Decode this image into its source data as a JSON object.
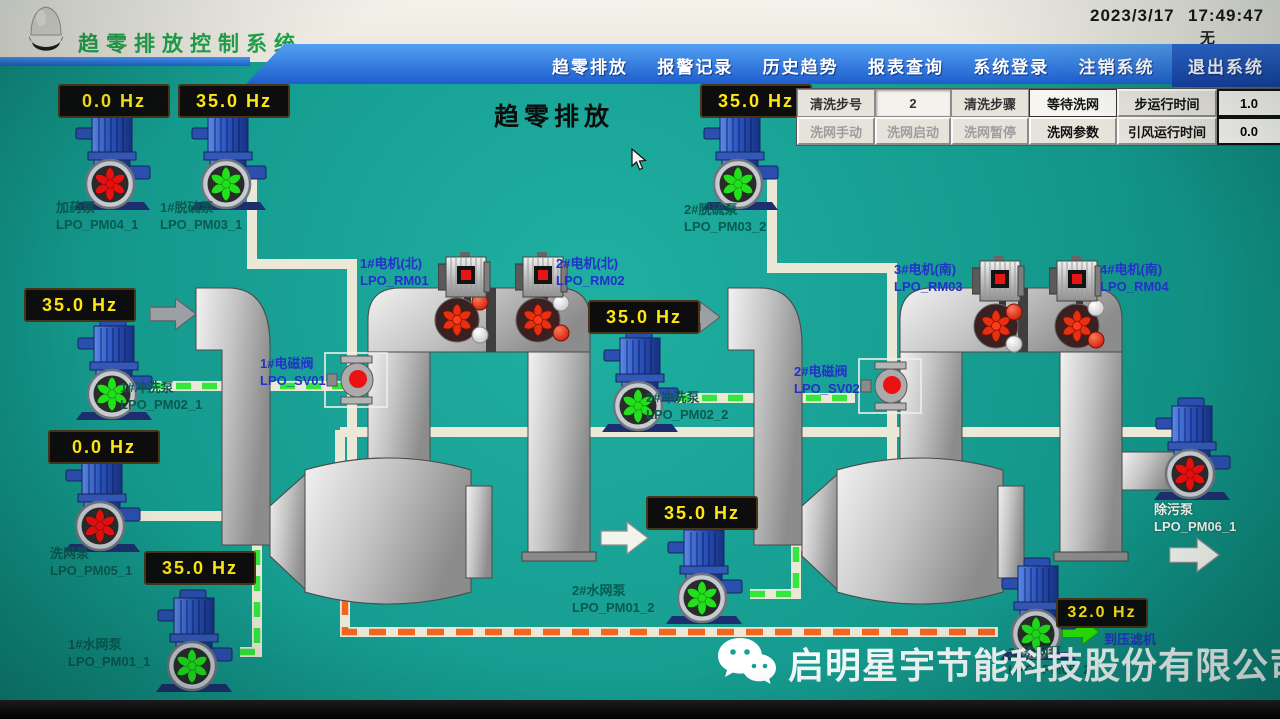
{
  "titlebar": {
    "system_title": "趋零排放控制系统",
    "date": "2023/3/17",
    "time": "17:49:47",
    "alarm_status": "无"
  },
  "menu": {
    "items": [
      {
        "label": "趋零排放"
      },
      {
        "label": "报警记录"
      },
      {
        "label": "历史趋势"
      },
      {
        "label": "报表查询"
      },
      {
        "label": "系统登录"
      },
      {
        "label": "注销系统"
      },
      {
        "label": "退出系统"
      }
    ]
  },
  "screen": {
    "title": "趋零排放",
    "to_filter_press": "到压滤机"
  },
  "wash_panel": {
    "step_no_label": "清洗步号",
    "step_no_value": "2",
    "step_label": "清洗步骤",
    "step_value": "等待洗网",
    "step_time_label": "步运行时间",
    "step_time_value": "1.0",
    "step_time_unit": "分",
    "manual_label": "洗网手动",
    "start_label": "洗网启动",
    "pause_label": "洗网暂停",
    "params_label": "洗网参数",
    "fan_time_label": "引风运行时间",
    "fan_time_value": "0.0",
    "fan_time_unit": "分"
  },
  "pumps": [
    {
      "name": "加药泵",
      "tag": "LPO_PM04_1",
      "hz": "0.0 Hz",
      "state": "stopped"
    },
    {
      "name": "1#脱硫泵",
      "tag": "LPO_PM03_1",
      "hz": "35.0 Hz",
      "state": "running"
    },
    {
      "name": "2#脱硫泵",
      "tag": "LPO_PM03_2",
      "hz": "35.0 Hz",
      "state": "running"
    },
    {
      "name": "1#冲洗泵",
      "tag": "LPO_PM02_1",
      "hz": "35.0 Hz",
      "state": "running"
    },
    {
      "name": "2#冲洗泵",
      "tag": "LPO_PM02_2",
      "hz": "35.0 Hz",
      "state": "running"
    },
    {
      "name": "洗网泵",
      "tag": "LPO_PM05_1",
      "hz": "0.0 Hz",
      "state": "stopped"
    },
    {
      "name": "1#水网泵",
      "tag": "LPO_PM01_1",
      "hz": "35.0 Hz",
      "state": "running"
    },
    {
      "name": "2#水网泵",
      "tag": "LPO_PM01_2",
      "hz": "35.0 Hz",
      "state": "running"
    },
    {
      "name": "2#洗网泵",
      "tag": "LPO_PM05_2",
      "hz": "32.0 Hz",
      "state": "running"
    },
    {
      "name": "除污泵",
      "tag": "LPO_PM06_1",
      "hz": "",
      "state": "stopped"
    }
  ],
  "motors": [
    {
      "name": "1#电机(北)",
      "tag": "LPO_RM01"
    },
    {
      "name": "2#电机(北)",
      "tag": "LPO_RM02"
    },
    {
      "name": "3#电机(南)",
      "tag": "LPO_RM03"
    },
    {
      "name": "4#电机(南)",
      "tag": "LPO_RM04"
    }
  ],
  "valves": [
    {
      "name": "1#电磁阀",
      "tag": "LPO_SV01"
    },
    {
      "name": "2#电磁阀",
      "tag": "LPO_SV02"
    }
  ],
  "watermark": {
    "text": "启明星宇节能科技股份有限公司",
    "icon": "wechat-icon"
  },
  "icons": {
    "logo": "lamp-icon",
    "flow": "arrow-icon"
  },
  "colors": {
    "running": "#22e01c",
    "stopped": "#ea1010",
    "menu_blue": "#1d5ecd",
    "hz_text": "#ffe712",
    "label_teal": "#0a5a50",
    "label_blue": "#2431c9",
    "title_green": "#22a24c",
    "pipe_green": "#35e63c",
    "pipe_orange": "#f2661f"
  }
}
